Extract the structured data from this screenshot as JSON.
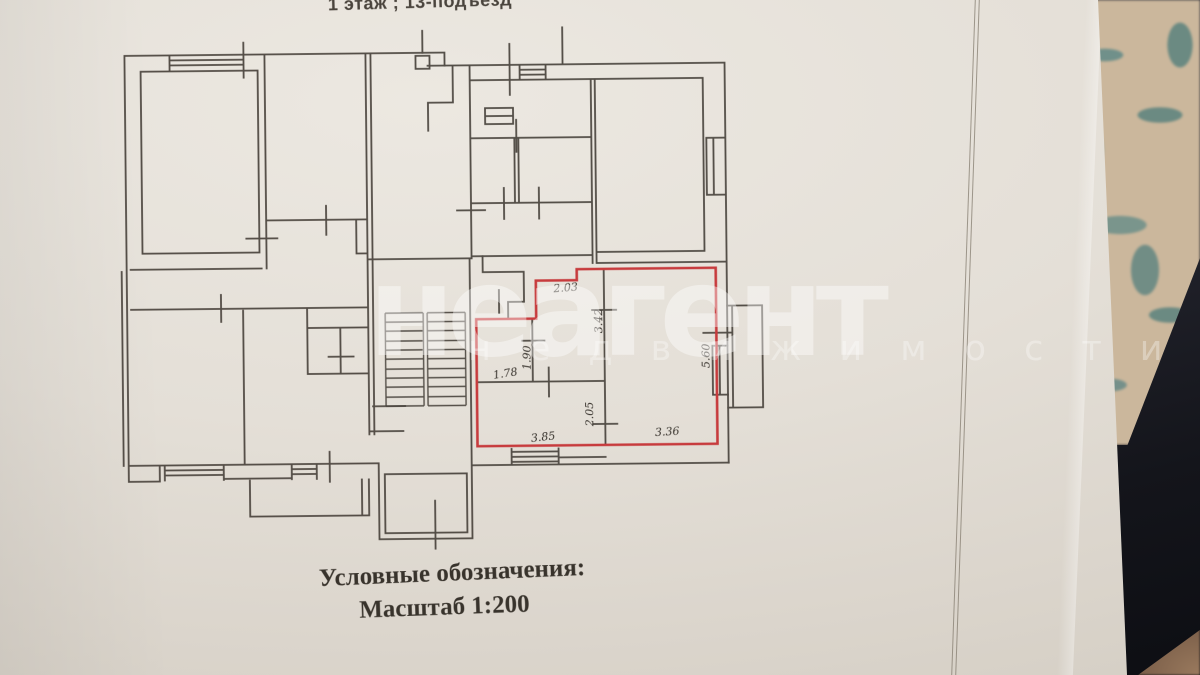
{
  "document": {
    "top_caption": "1 этаж ; 13-подъезд",
    "legend": {
      "title": "Условные обозначения:",
      "scale": "Масштаб 1:200"
    },
    "watermark": {
      "main": "неагент",
      "sub": "недвижимости"
    }
  },
  "floor_plan": {
    "type": "apartment-building-floor-plan-photo",
    "scale": "1:200",
    "highlight_color": "#c73b3d",
    "line_color": "#46403a",
    "paper_color": "#e4dfd7",
    "background_colors": {
      "fabric": "#cbb79c",
      "fabric_leaves": "#6f8e86",
      "shadow": "#1d1e26",
      "surface": "#8c6b52"
    },
    "highlighted_unit_dimensions_m": [
      {
        "value": "2.03",
        "orientation": "horizontal",
        "location": "hall-top"
      },
      {
        "value": "3.42",
        "orientation": "vertical",
        "location": "hall-right-wall-upper"
      },
      {
        "value": "1.90",
        "orientation": "vertical",
        "location": "closet-wall"
      },
      {
        "value": "1.78",
        "orientation": "horizontal",
        "location": "closet-width"
      },
      {
        "value": "5.60",
        "orientation": "vertical",
        "location": "main-room-right-wall"
      },
      {
        "value": "2.05",
        "orientation": "vertical",
        "location": "left-room-wall-lower"
      },
      {
        "value": "3.85",
        "orientation": "horizontal",
        "location": "left-room-bottom"
      },
      {
        "value": "3.36",
        "orientation": "horizontal",
        "location": "main-room-bottom"
      }
    ]
  }
}
